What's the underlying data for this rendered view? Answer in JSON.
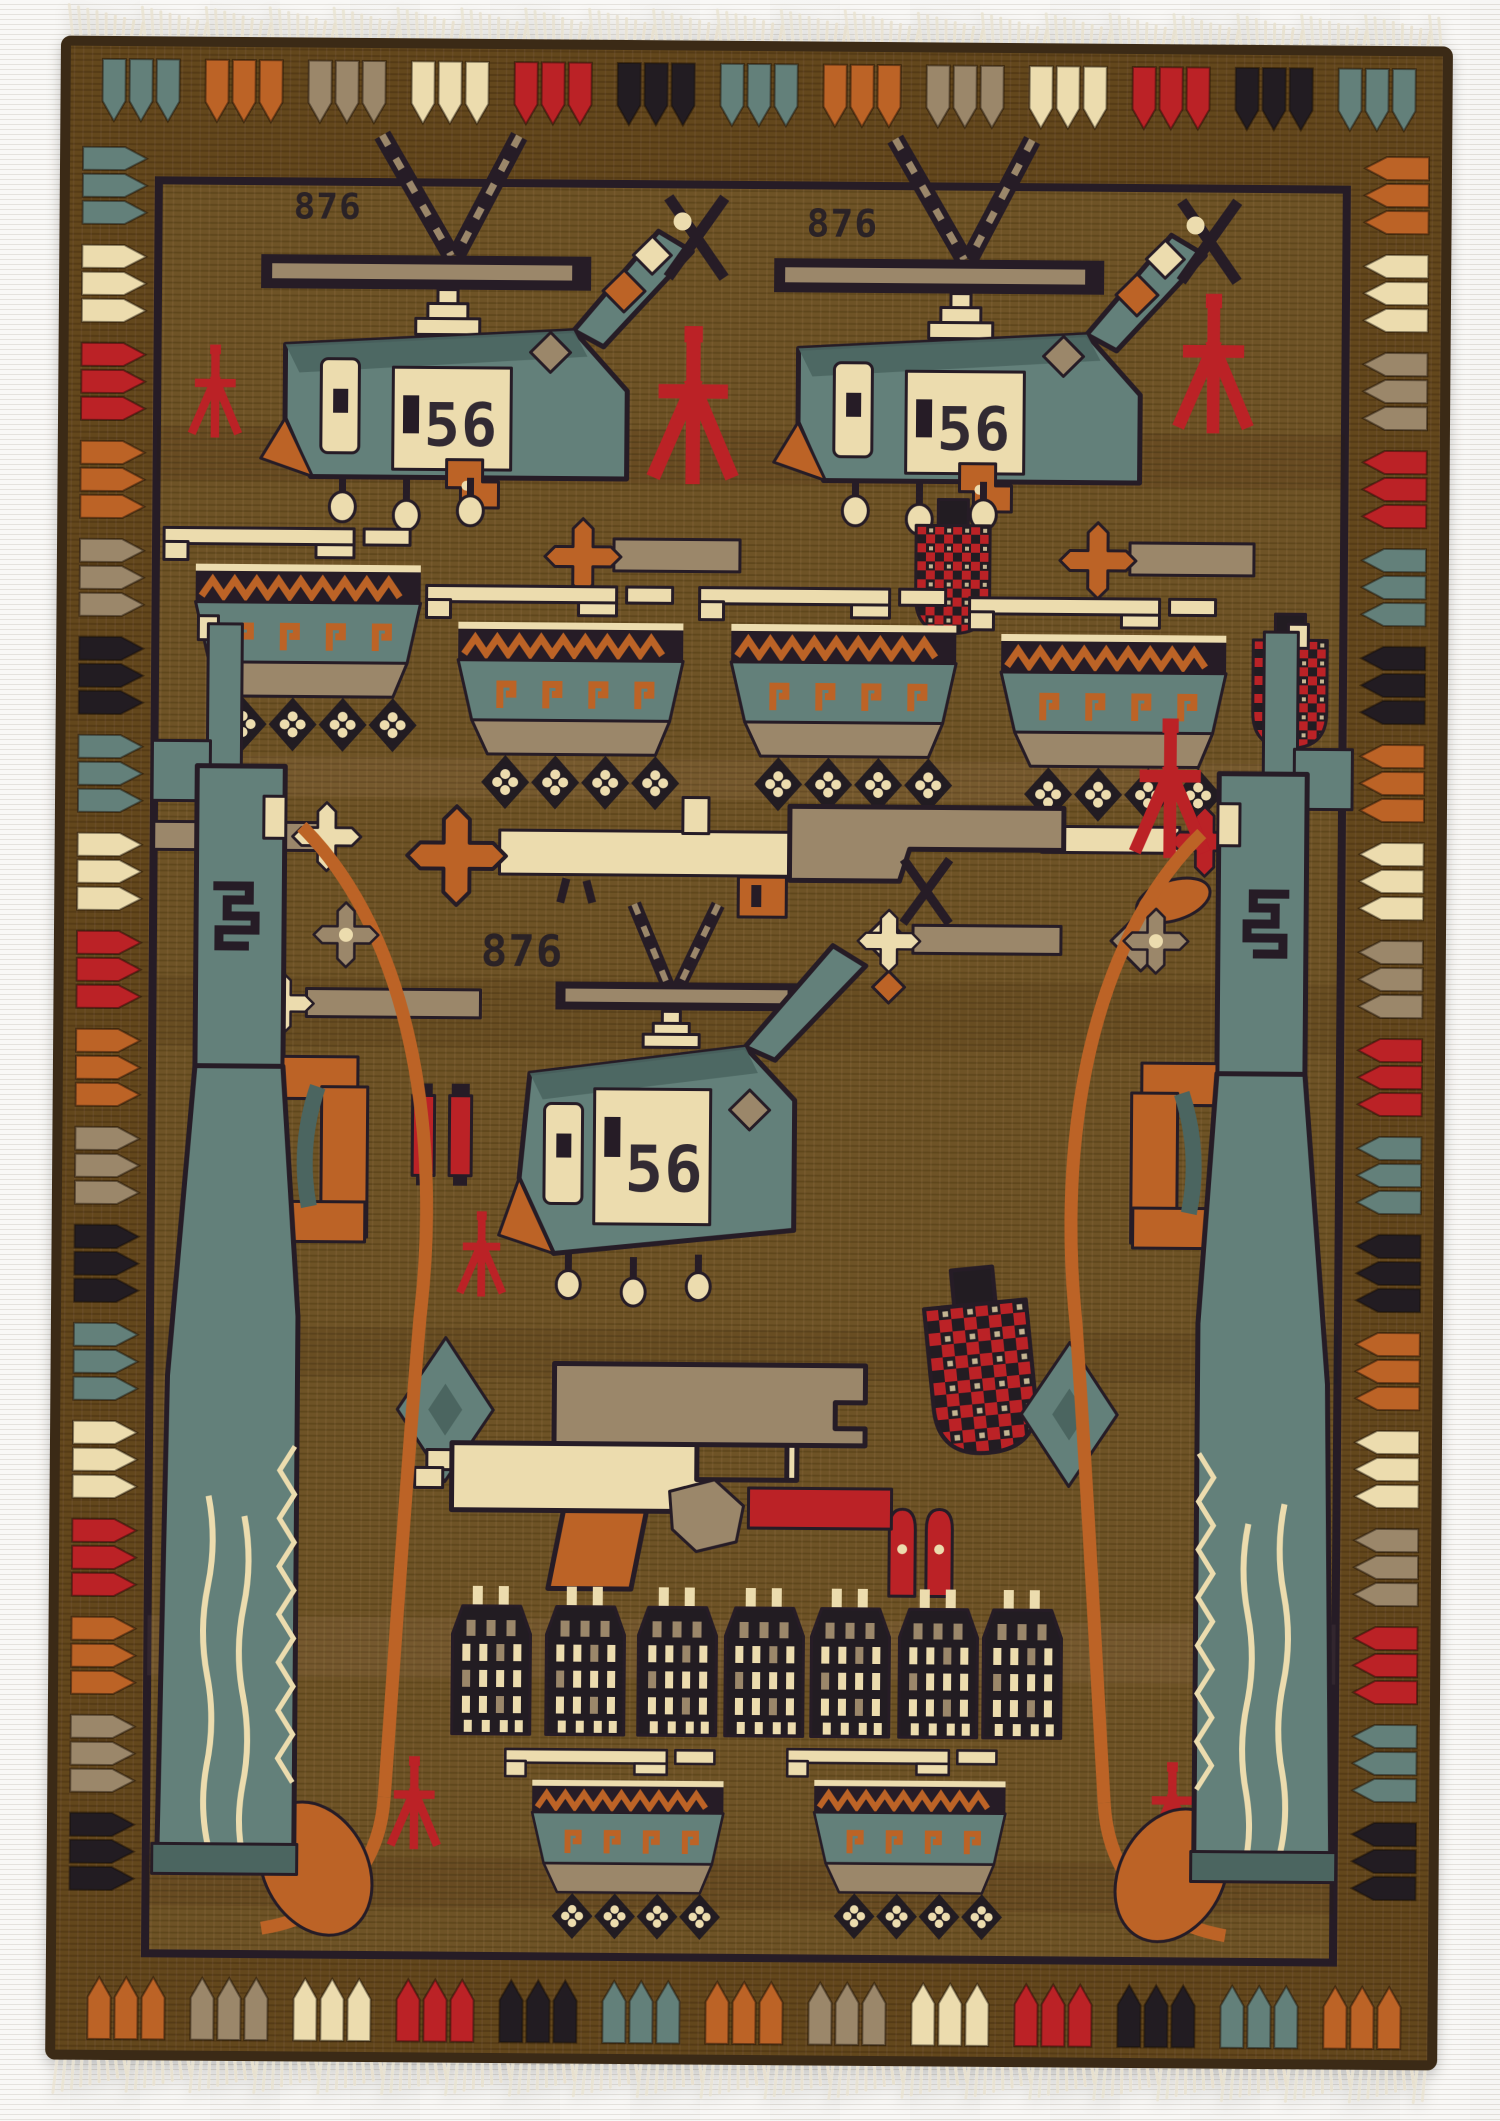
{
  "subject": "Hand-knotted Afghan war rug photographed on a light textured background, cream fringe at top and bottom",
  "rug": {
    "serials": {
      "one": "876",
      "two": "876",
      "three": "876"
    },
    "numbers": {
      "one": "56",
      "two": "56",
      "three": "56"
    },
    "colors": {
      "photo_bg": "#f1efeb",
      "field": "#6e5226",
      "border_bg": "#63461d",
      "outline": "#261e28",
      "teal": "#63807a",
      "teal_dark": "#4b6560",
      "cream": "#ecdcae",
      "orange": "#bc6327",
      "red": "#bb2026",
      "tan": "#9b876a",
      "black": "#211b24",
      "fringe": "#e8e1cf",
      "selvedge": "#3a2a12"
    },
    "border_cycles": {
      "top": [
        "teal",
        "orange",
        "tan",
        "cream",
        "red",
        "black"
      ],
      "bottom": [
        "orange",
        "tan",
        "cream",
        "red",
        "black",
        "teal"
      ],
      "left": [
        "teal",
        "cream",
        "red",
        "orange",
        "tan",
        "black"
      ],
      "right": [
        "orange",
        "cream",
        "tan",
        "red",
        "teal",
        "black"
      ]
    },
    "depicted": {
      "helicopters": 3,
      "tanks": 6,
      "assault_rifles_vertical": 2,
      "rifle_horizontal": 1,
      "pistol": 1,
      "grenades": 3,
      "red_tripods": 7,
      "ammunition_boxes": 7,
      "mace_flowers": 6
    }
  }
}
